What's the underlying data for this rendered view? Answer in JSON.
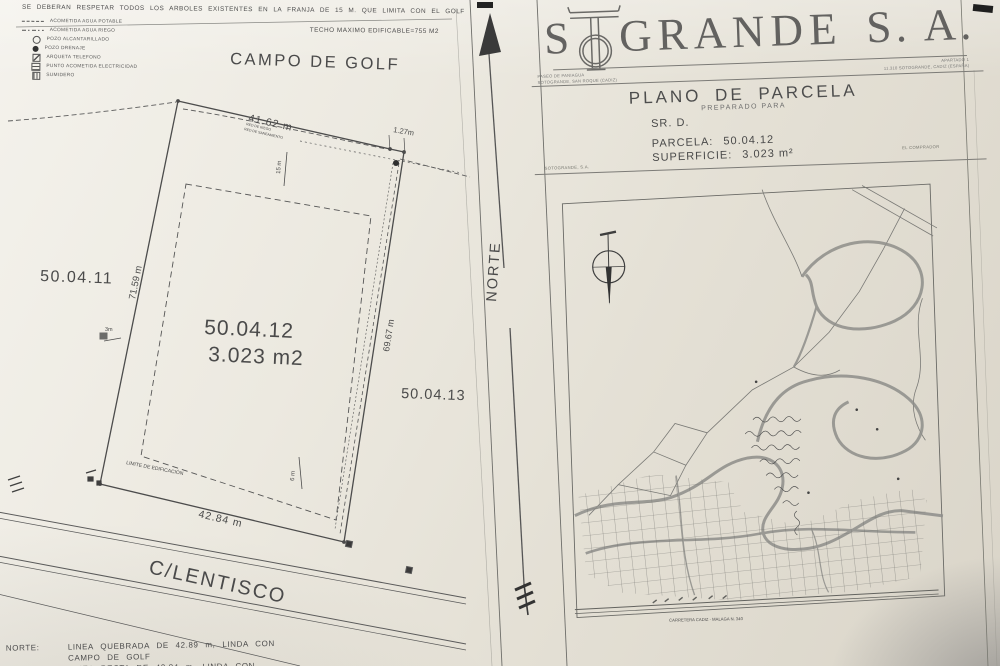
{
  "notes": {
    "top_note": "SE DEBERAN RESPETAR TODOS LOS ARBOLES EXISTENTES EN LA FRANJA DE 15 M. QUE LIMITA CON EL GOLF",
    "techo": "TECHO MAXIMO EDIFICABLE=755 M2"
  },
  "legend": {
    "items": [
      {
        "symbol": "dashed-line",
        "label": "ACOMETIDA AGUA POTABLE"
      },
      {
        "symbol": "dash-dot-line",
        "label": "ACOMETIDA AGUA RIEGO"
      },
      {
        "symbol": "circle-outline",
        "label": "POZO ALCANTARILLADO"
      },
      {
        "symbol": "circle-filled",
        "label": "POZO DRENAJE"
      },
      {
        "symbol": "square-diagonal",
        "label": "ARQUETA TELEFONO"
      },
      {
        "symbol": "square-hatched",
        "label": "PUNTO ACOMETIDA ELECTRICIDAD"
      },
      {
        "symbol": "square-grid",
        "label": "SUMIDERO"
      }
    ]
  },
  "plot": {
    "golf_label": "CAMPO DE GOLF",
    "street_label": "C/LENTISCO",
    "parcel_number": "50.04.12",
    "parcel_area": "3.023 m2",
    "neighbor_left": "50.04.11",
    "neighbor_right": "50.04.13",
    "dim_top": "41.62 m",
    "dim_top_small": "1.27m",
    "dim_left": "71.59 m",
    "dim_right": "69.67 m",
    "dim_bottom": "42.84 m",
    "setback_top": "15 m",
    "setback_left": "3m",
    "setback_bottom": "6 m",
    "building_limit_label": "LIMITE DE EDIFICACIÓN",
    "utility_note_1": "RED DE RIEGO",
    "utility_note_2": "RED DE SANEAMIENTO"
  },
  "north": {
    "label": "NORTE"
  },
  "header": {
    "company_full": "SOTOGRANDE S.A.",
    "company_prefix": "S",
    "company_rest": "GRANDE",
    "company_suffix": "S. A.",
    "address_left_1": "PASEO DE PANIAGUA",
    "address_left_2": "SOTOGRANDE, SAN ROQUE (CADIZ)",
    "address_right_1": "APARTADO 1",
    "address_right_2": "11.310 SOTOGRANDE, CADIZ (ESPAÑA)",
    "title": "PLANO DE PARCELA",
    "subtitle": "PREPARADO PARA",
    "client": "SR. D.",
    "parcela_label": "PARCELA:",
    "parcela_value": "50.04.12",
    "superficie_label": "SUPERFICIE:",
    "superficie_value": "3.023 m²",
    "signer_left": "SOTOGRANDE, S.A.",
    "signer_right": "EL COMPRADOR"
  },
  "map": {
    "road_caption": "CARRETERA CADIZ - MALAGA N. 340"
  },
  "footer": {
    "line1_label": "NORTE:",
    "line1": "LINEA QUEBRADA DE 42.89 m, LINDA CON",
    "line2": "CAMPO DE GOLF",
    "line3": "LINEA RECTA DE 42.84 m, LINDA CON"
  }
}
